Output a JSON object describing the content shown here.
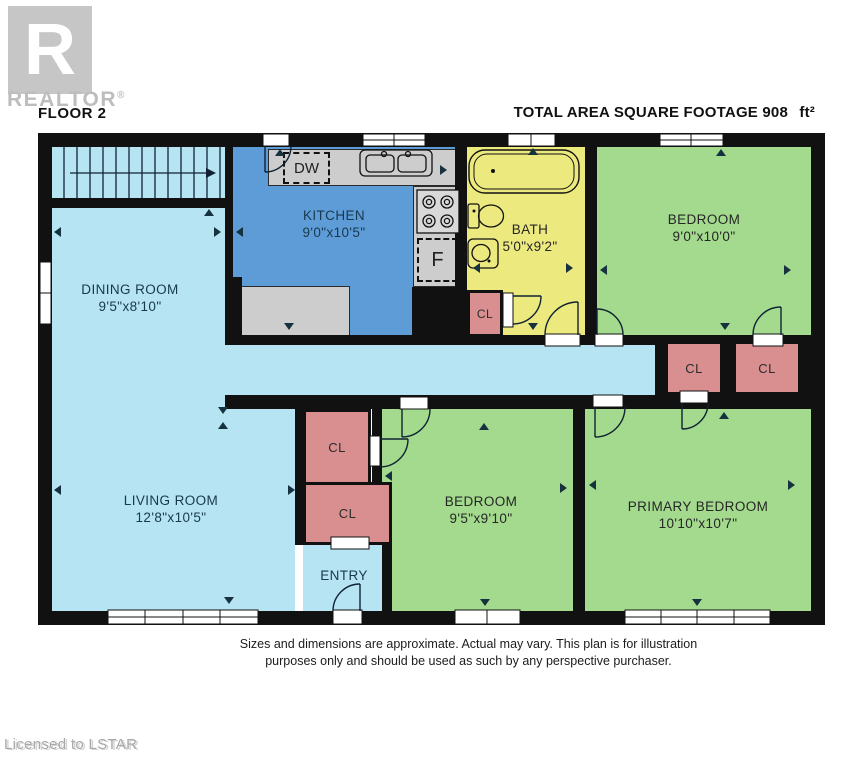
{
  "branding": {
    "logo_letter": "R",
    "logo_wordmark": "REALTOR",
    "registered_symbol": "®",
    "license_note": "Licensed to LSTAR"
  },
  "header": {
    "floor_label": "FLOOR 2",
    "area_label": "TOTAL AREA SQUARE FOOTAGE",
    "area_value": "908",
    "area_unit": "ft²"
  },
  "rooms": {
    "kitchen": {
      "name": "KITCHEN",
      "dims": "9'0\"x10'5\""
    },
    "bath": {
      "name": "BATH",
      "dims": "5'0\"x9'2\""
    },
    "bedroom_top": {
      "name": "BEDROOM",
      "dims": "9'0\"x10'0\""
    },
    "dining": {
      "name": "DINING ROOM",
      "dims": "9'5\"x8'10\""
    },
    "living": {
      "name": "LIVING ROOM",
      "dims": "12'8\"x10'5\""
    },
    "bedroom_mid": {
      "name": "BEDROOM",
      "dims": "9'5\"x9'10\""
    },
    "primary": {
      "name": "PRIMARY BEDROOM",
      "dims": "10'10\"x10'7\""
    },
    "entry": {
      "name": "ENTRY"
    }
  },
  "closets": [
    {
      "label": "CL"
    },
    {
      "label": "CL"
    },
    {
      "label": "CL"
    },
    {
      "label": "CL"
    },
    {
      "label": "CL"
    }
  ],
  "fixtures": {
    "dishwasher": "DW",
    "fridge": "F"
  },
  "footer": {
    "disclaimer_line1": "Sizes and dimensions are approximate. Actual may vary. This plan is for illustration",
    "disclaimer_line2": "purposes only and should be used as such by any perspective purchaser."
  },
  "colors": {
    "room_blue_light": "#b7e4f2",
    "room_blue": "#5e9cd8",
    "room_yellow": "#ece97e",
    "room_green": "#a3da8d",
    "closet_pink": "#d98f8f",
    "counter_grey": "#cdcdcd",
    "wall_black": "#111111"
  }
}
